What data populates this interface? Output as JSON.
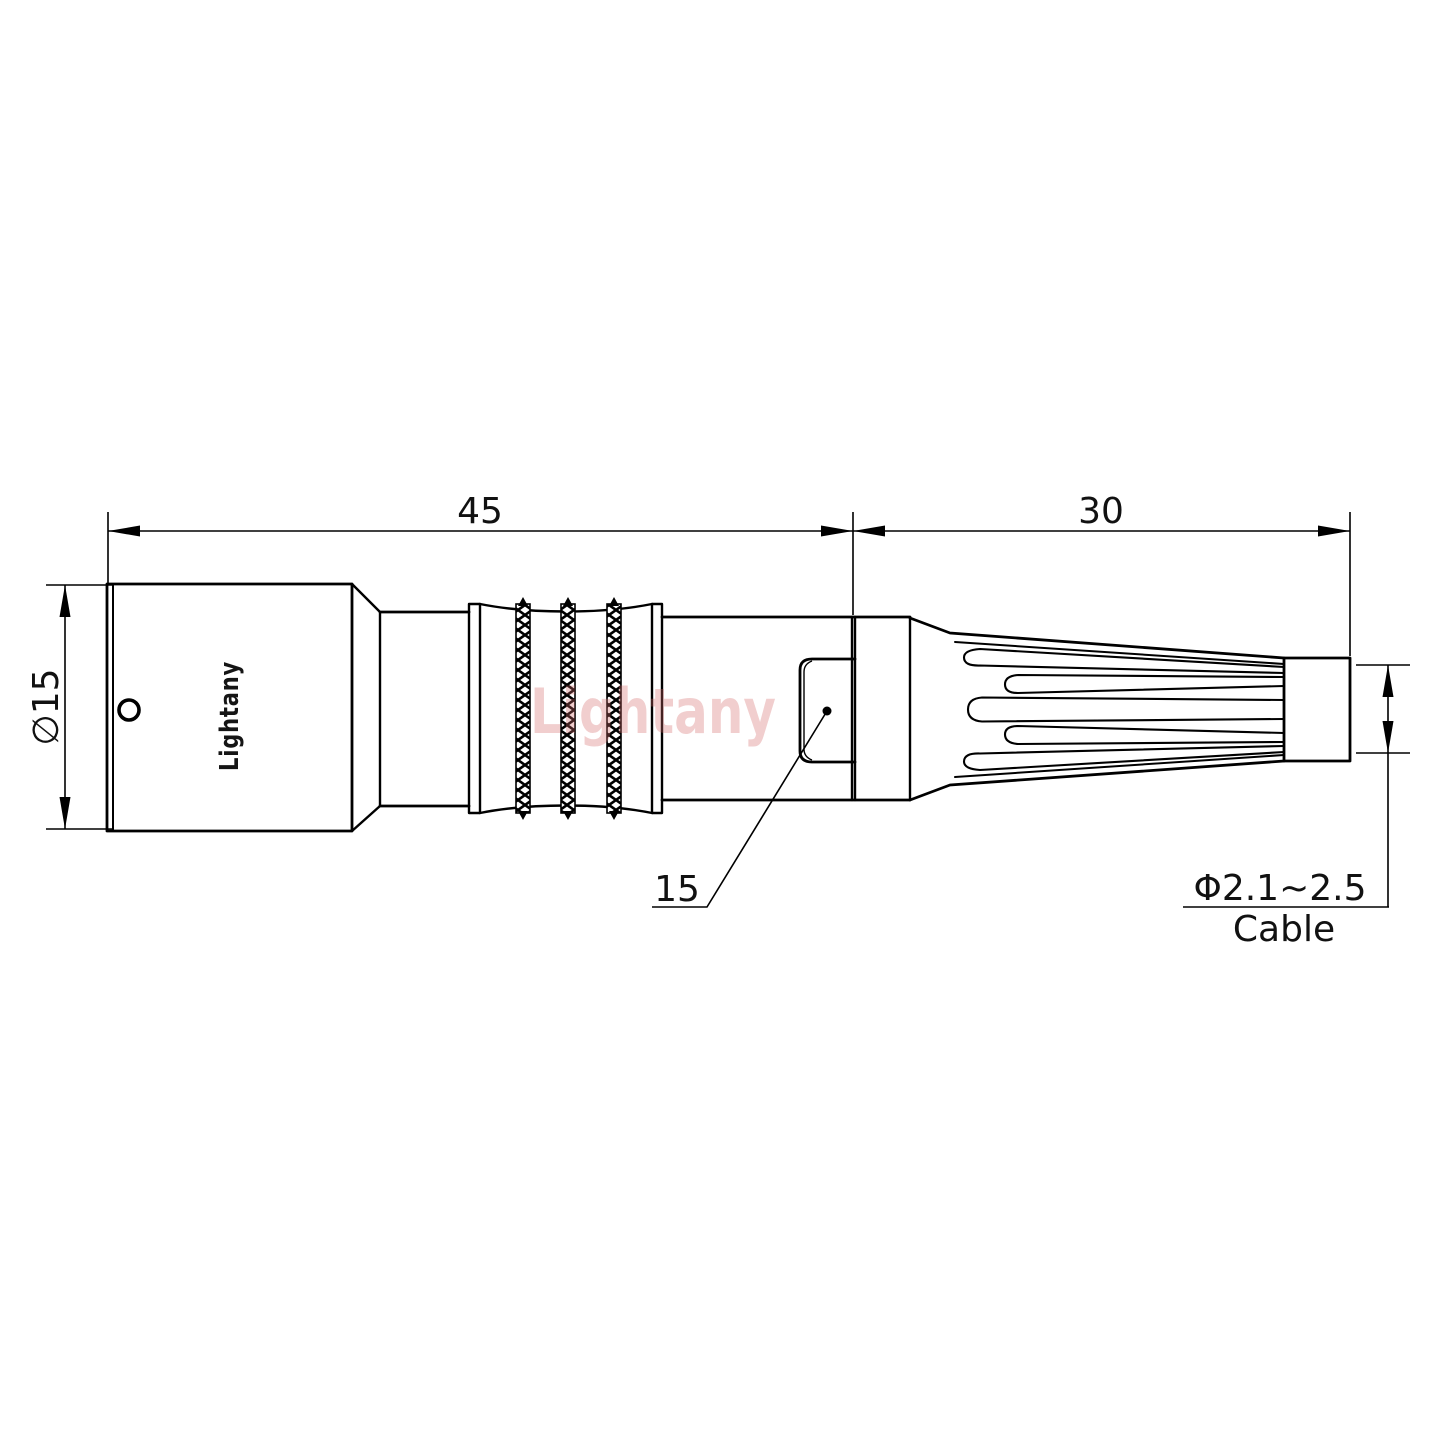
{
  "page": {
    "background": "#ffffff"
  },
  "drawing": {
    "watermark": "Lightany",
    "brand_label": "Lightany",
    "dimensions": {
      "body_length": "45",
      "strain_relief_length": "30",
      "body_diameter": "∅15",
      "latch_size": "15",
      "cable_diameter": "Φ2.1~2.5",
      "cable_label": "Cable"
    },
    "colors": {
      "line": "#000000",
      "watermark": "#d46a6a",
      "brand_text": "#151515"
    }
  }
}
